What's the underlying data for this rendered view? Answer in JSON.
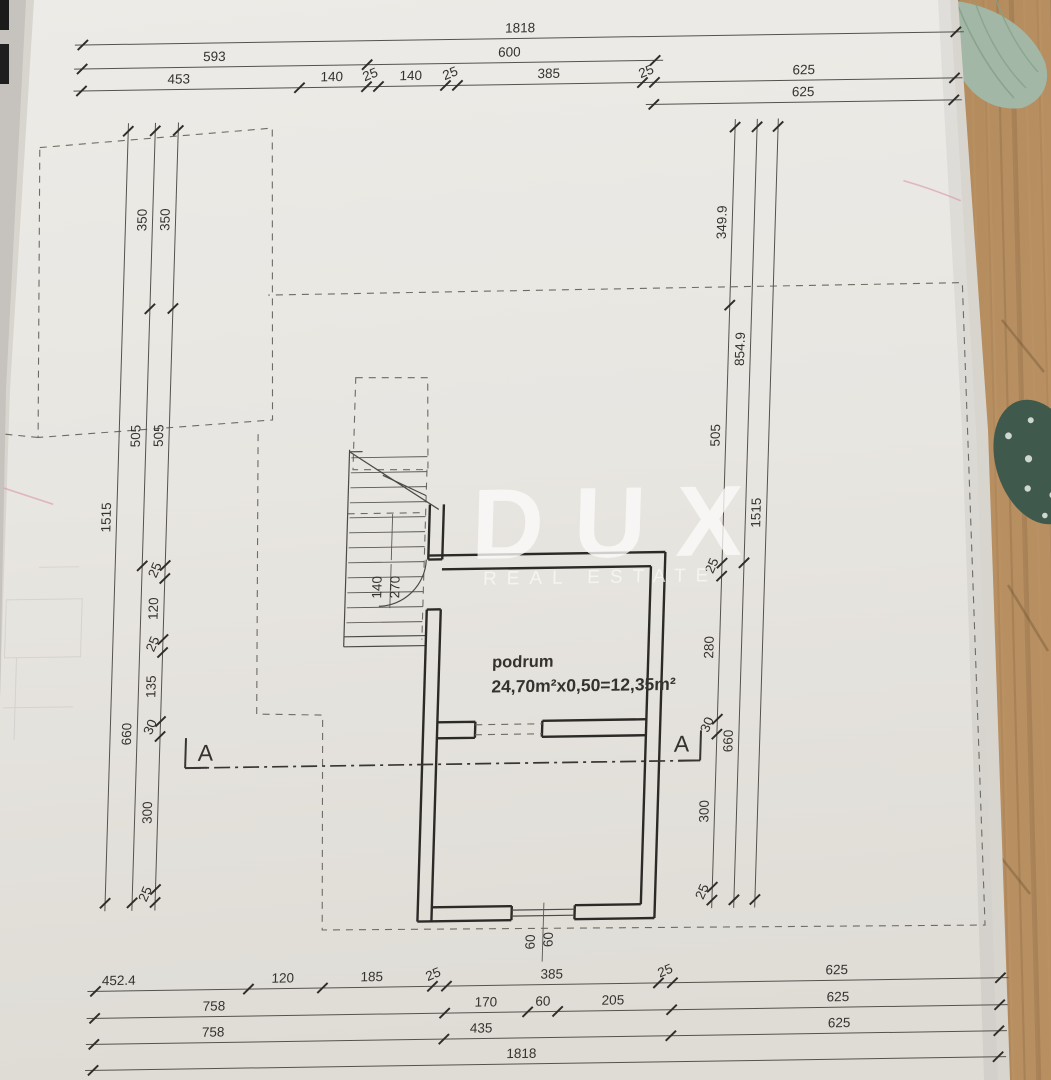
{
  "watermark": {
    "title": "DUX",
    "subtitle": "REAL ESTATE"
  },
  "room": {
    "name": "podrum",
    "area_formula": "24,70m²x0,50=12,35m²"
  },
  "section": {
    "marker": "A"
  },
  "dimensions": {
    "top": [
      {
        "t": "1818",
        "x": 505,
        "y": 32,
        "r": 0
      },
      {
        "t": "593",
        "x": 200,
        "y": 56,
        "r": 0
      },
      {
        "t": "600",
        "x": 495,
        "y": 56,
        "r": 0
      },
      {
        "t": "453",
        "x": 165,
        "y": 78,
        "r": 0
      },
      {
        "t": "140",
        "x": 318,
        "y": 78,
        "r": 0
      },
      {
        "t": "25",
        "x": 358,
        "y": 76,
        "r": -22
      },
      {
        "t": "140",
        "x": 397,
        "y": 78,
        "r": 0
      },
      {
        "t": "25",
        "x": 438,
        "y": 76,
        "r": -22
      },
      {
        "t": "385",
        "x": 535,
        "y": 78,
        "r": 0
      },
      {
        "t": "25",
        "x": 634,
        "y": 77,
        "r": -22
      },
      {
        "t": "625",
        "x": 790,
        "y": 78,
        "r": 0
      },
      {
        "t": "625",
        "x": 790,
        "y": 100,
        "r": 0
      }
    ],
    "bottom": [
      {
        "t": "452.4",
        "x": 132,
        "y": 979,
        "r": 0
      },
      {
        "t": "120",
        "x": 296,
        "y": 979,
        "r": 0
      },
      {
        "t": "185",
        "x": 385,
        "y": 979,
        "r": 0
      },
      {
        "t": "25",
        "x": 448,
        "y": 977,
        "r": -22
      },
      {
        "t": "385",
        "x": 565,
        "y": 979,
        "r": 0
      },
      {
        "t": "25",
        "x": 680,
        "y": 977,
        "r": -22
      },
      {
        "t": "625",
        "x": 850,
        "y": 979,
        "r": 0
      },
      {
        "t": "758",
        "x": 228,
        "y": 1006,
        "r": 0
      },
      {
        "t": "170",
        "x": 500,
        "y": 1006,
        "r": 0
      },
      {
        "t": "60",
        "x": 557,
        "y": 1006,
        "r": 0
      },
      {
        "t": "205",
        "x": 627,
        "y": 1006,
        "r": 0
      },
      {
        "t": "625",
        "x": 852,
        "y": 1006,
        "r": 0
      },
      {
        "t": "758",
        "x": 228,
        "y": 1032,
        "r": 0
      },
      {
        "t": "435",
        "x": 496,
        "y": 1032,
        "r": 0
      },
      {
        "t": "625",
        "x": 854,
        "y": 1032,
        "r": 0
      },
      {
        "t": "1818",
        "x": 537,
        "y": 1058,
        "r": 0
      }
    ],
    "left": [
      {
        "t": "350",
        "x": 137,
        "y": 214,
        "r": -90
      },
      {
        "t": "350",
        "x": 160,
        "y": 214,
        "r": -90
      },
      {
        "t": "505",
        "x": 137,
        "y": 430,
        "r": -90
      },
      {
        "t": "505",
        "x": 160,
        "y": 430,
        "r": -90
      },
      {
        "t": "1515",
        "x": 110,
        "y": 511,
        "r": -90
      },
      {
        "t": "25",
        "x": 160,
        "y": 566,
        "r": -68
      },
      {
        "t": "120",
        "x": 160,
        "y": 603,
        "r": -90
      },
      {
        "t": "25",
        "x": 160,
        "y": 640,
        "r": -68
      },
      {
        "t": "135",
        "x": 160,
        "y": 681,
        "r": -90
      },
      {
        "t": "30",
        "x": 160,
        "y": 723,
        "r": -68
      },
      {
        "t": "660",
        "x": 137,
        "y": 728,
        "r": -90
      },
      {
        "t": "300",
        "x": 160,
        "y": 807,
        "r": -90
      },
      {
        "t": "25",
        "x": 160,
        "y": 890,
        "r": -68
      }
    ],
    "right": [
      {
        "t": "349.9",
        "x": 717,
        "y": 225,
        "r": -90
      },
      {
        "t": "854.9",
        "x": 739,
        "y": 352,
        "r": -90
      },
      {
        "t": "505",
        "x": 717,
        "y": 438,
        "r": -90
      },
      {
        "t": "1515",
        "x": 760,
        "y": 516,
        "r": -90
      },
      {
        "t": "25",
        "x": 717,
        "y": 570,
        "r": -68
      },
      {
        "t": "280",
        "x": 717,
        "y": 650,
        "r": -90
      },
      {
        "t": "30",
        "x": 717,
        "y": 729,
        "r": -68
      },
      {
        "t": "660",
        "x": 739,
        "y": 744,
        "r": -90
      },
      {
        "t": "300",
        "x": 717,
        "y": 814,
        "r": -90
      },
      {
        "t": "25",
        "x": 717,
        "y": 896,
        "r": -68
      }
    ],
    "window": [
      {
        "t": "60",
        "x": 547,
        "y": 942,
        "r": -90
      },
      {
        "t": "60",
        "x": 565,
        "y": 940,
        "r": -90
      }
    ],
    "stair": [
      {
        "t": "140",
        "x": 383,
        "y": 585,
        "r": -90
      },
      {
        "t": "270",
        "x": 401,
        "y": 585,
        "r": -90
      }
    ]
  }
}
